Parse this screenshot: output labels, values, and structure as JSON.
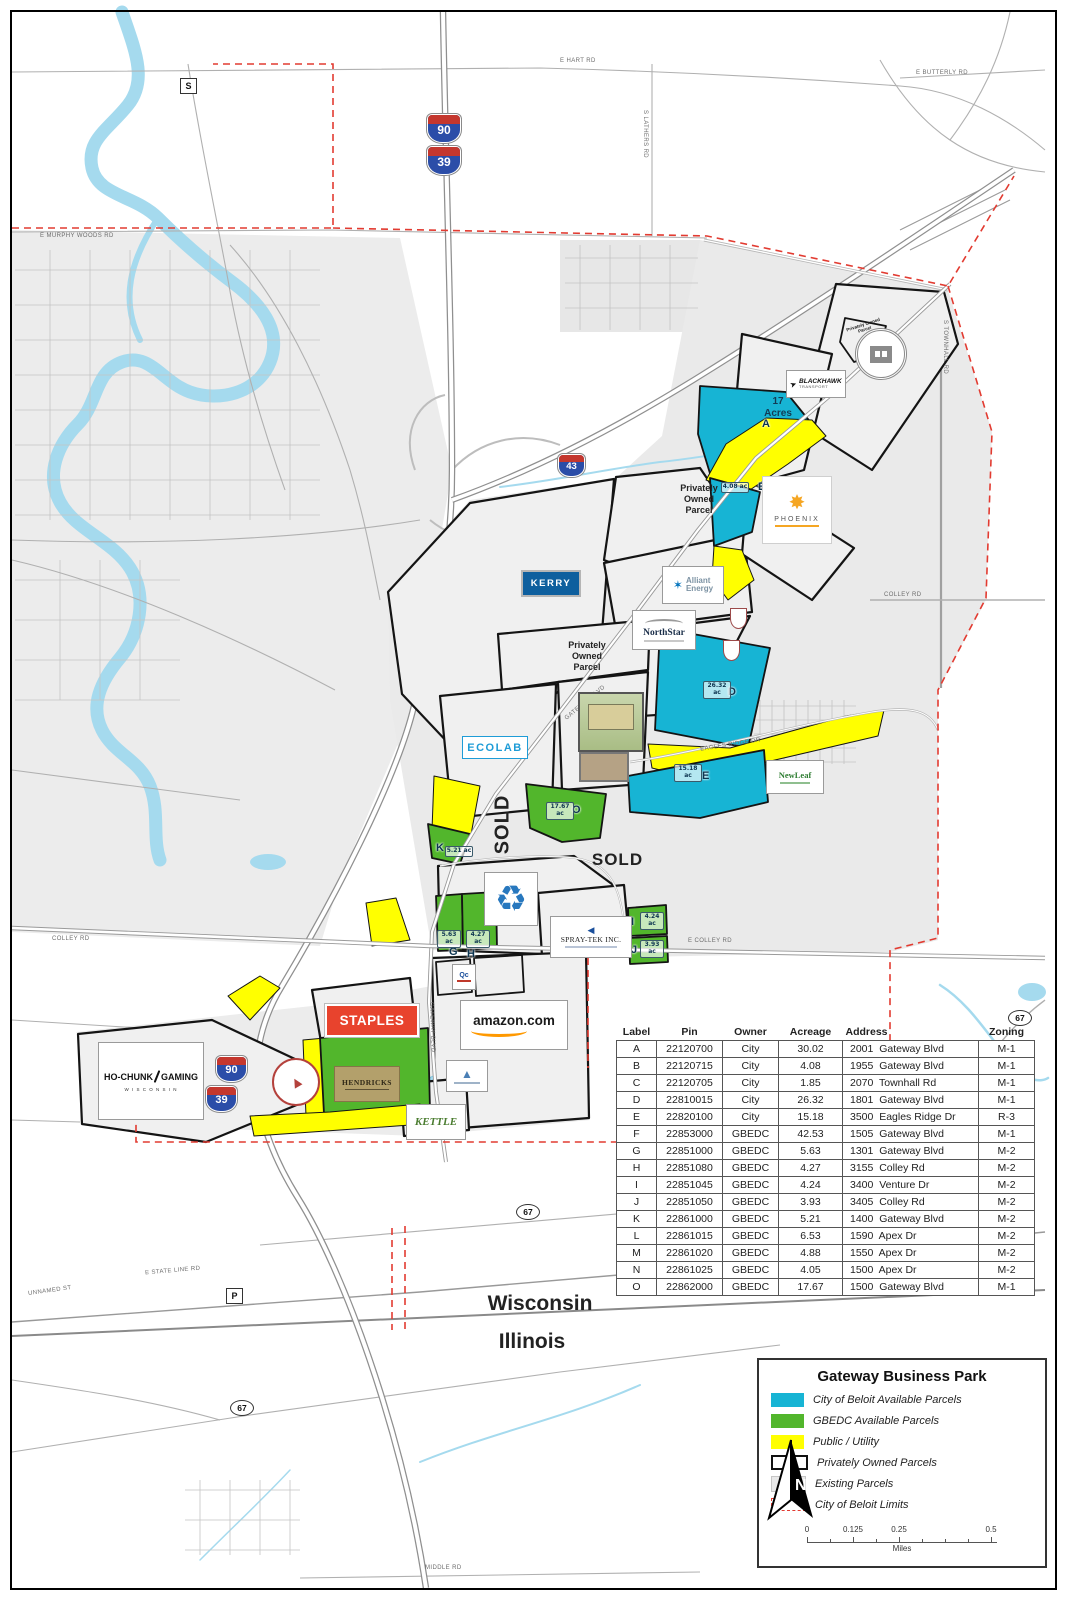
{
  "colors": {
    "city_parcel": "#17b4d4",
    "gbedc_parcel": "#52b62c",
    "public_utility": "#ffff00",
    "boundary_red": "#e23b31",
    "water": "#a5daee",
    "staples_red": "#e8432d",
    "amazon_orange": "#ff9900",
    "kerry_blue": "#0e5f9e",
    "ecolab_blue": "#1e9cd7",
    "phoenix_orange": "#f5a623",
    "hendricks_tan": "#b3a06b",
    "kettle_green": "#4a7c2f"
  },
  "labels": {
    "privately_owned": "Privately Owned Parcel",
    "seventeen_acres": "17 Acres",
    "sold": "SOLD",
    "wisconsin": "Wisconsin",
    "illinois": "Illinois"
  },
  "roads": {
    "e_hart_rd": "E HART RD",
    "e_butterly_rd": "E BUTTERLY RD",
    "e_murphy_woods_rd": "E MURPHY WOODS RD",
    "s_lathers_rd": "S LATHERS RD",
    "s_townhall_rd": "S TOWNHALL RD",
    "colley_rd": "COLLEY RD",
    "e_colley_rd": "E COLLEY RD",
    "eagles_ridge_dr": "EAGLES RIDGE DR",
    "gateway_blvd": "GATEWAY BLVD",
    "e_state_line_rd": "E STATE LINE RD",
    "unnamed_st": "UNNAMED ST",
    "middle_rd": "MIDDLE RD"
  },
  "badges": {
    "i90": "90",
    "i39": "39",
    "i43": "43",
    "s": "S",
    "p": "P",
    "r67": "67"
  },
  "parcels": {
    "a": {
      "letter": "A"
    },
    "b": {
      "letter": "B",
      "acreage": "4.08 ac"
    },
    "d": {
      "letter": "D",
      "acreage": "26.32 ac"
    },
    "e": {
      "letter": "E",
      "acreage": "15.18 ac"
    },
    "g": {
      "letter": "G",
      "acreage": "5.63 ac"
    },
    "h": {
      "letter": "H",
      "acreage": "4.27 ac"
    },
    "i": {
      "letter": "I",
      "acreage": "4.24 ac"
    },
    "j": {
      "letter": "J",
      "acreage": "3.93 ac"
    },
    "k": {
      "letter": "K",
      "acreage": "5.21 ac"
    },
    "o": {
      "letter": "O",
      "acreage": "17.67 ac"
    }
  },
  "logos": {
    "kerry": "KERRY",
    "alliant_line1": "Alliant",
    "alliant_line2": "Energy",
    "northstar": "NorthStar",
    "ecolab": "ECOLAB",
    "phoenix": "PHOENIX",
    "blackhawk": "BLACKHAWK",
    "blackhawk_sub": "TRANSPORT",
    "staples": "STAPLES",
    "amazon": "amazon.com",
    "spraytek": "SPRAY-TEK INC.",
    "hochunk_line1": "HO-CHUNK",
    "hochunk_line2": "GAMING",
    "hochunk_sub": "W I S C O N S I N",
    "hendricks": "HENDRICKS",
    "kettle": "KETTLE",
    "newleaf": "NewLeaf",
    "qc": "Qc"
  },
  "table": {
    "headers": [
      "Label",
      "Pin",
      "Owner",
      "Acreage",
      "Address",
      "Zoning"
    ],
    "rows": [
      {
        "label": "A",
        "pin": "22120700",
        "owner": "City",
        "acreage": "30.02",
        "address": "2001  Gateway Blvd",
        "zoning": "M-1"
      },
      {
        "label": "B",
        "pin": "22120715",
        "owner": "City",
        "acreage": "4.08",
        "address": "1955  Gateway Blvd",
        "zoning": "M-1"
      },
      {
        "label": "C",
        "pin": "22120705",
        "owner": "City",
        "acreage": "1.85",
        "address": "2070  Townhall Rd",
        "zoning": "M-1"
      },
      {
        "label": "D",
        "pin": "22810015",
        "owner": "City",
        "acreage": "26.32",
        "address": "1801  Gateway Blvd",
        "zoning": "M-1"
      },
      {
        "label": "E",
        "pin": "22820100",
        "owner": "City",
        "acreage": "15.18",
        "address": "3500  Eagles Ridge Dr",
        "zoning": "R-3"
      },
      {
        "label": "F",
        "pin": "22853000",
        "owner": "GBEDC",
        "acreage": "42.53",
        "address": "1505  Gateway Blvd",
        "zoning": "M-1"
      },
      {
        "label": "G",
        "pin": "22851000",
        "owner": "GBEDC",
        "acreage": "5.63",
        "address": "1301  Gateway Blvd",
        "zoning": "M-2"
      },
      {
        "label": "H",
        "pin": "22851080",
        "owner": "GBEDC",
        "acreage": "4.27",
        "address": "3155  Colley Rd",
        "zoning": "M-2"
      },
      {
        "label": "I",
        "pin": "22851045",
        "owner": "GBEDC",
        "acreage": "4.24",
        "address": "3400  Venture Dr",
        "zoning": "M-2"
      },
      {
        "label": "J",
        "pin": "22851050",
        "owner": "GBEDC",
        "acreage": "3.93",
        "address": "3405  Colley Rd",
        "zoning": "M-2"
      },
      {
        "label": "K",
        "pin": "22861000",
        "owner": "GBEDC",
        "acreage": "5.21",
        "address": "1400  Gateway Blvd",
        "zoning": "M-2"
      },
      {
        "label": "L",
        "pin": "22861015",
        "owner": "GBEDC",
        "acreage": "6.53",
        "address": "1590  Apex Dr",
        "zoning": "M-2"
      },
      {
        "label": "M",
        "pin": "22861020",
        "owner": "GBEDC",
        "acreage": "4.88",
        "address": "1550  Apex Dr",
        "zoning": "M-2"
      },
      {
        "label": "N",
        "pin": "22861025",
        "owner": "GBEDC",
        "acreage": "4.05",
        "address": "1500  Apex Dr",
        "zoning": "M-2"
      },
      {
        "label": "O",
        "pin": "22862000",
        "owner": "GBEDC",
        "acreage": "17.67",
        "address": "1500  Gateway Blvd",
        "zoning": "M-1"
      }
    ]
  },
  "legend": {
    "title": "Gateway Business Park",
    "items": [
      "City of Beloit Available Parcels",
      "GBEDC Available Parcels",
      "Public / Utility",
      "Privately Owned Parcels",
      "Existing Parcels",
      "City of Beloit Limits"
    ],
    "scale_ticks": [
      "0",
      "0.125",
      "0.25",
      "0.5"
    ],
    "scale_unit": "Miles",
    "north": "N"
  }
}
